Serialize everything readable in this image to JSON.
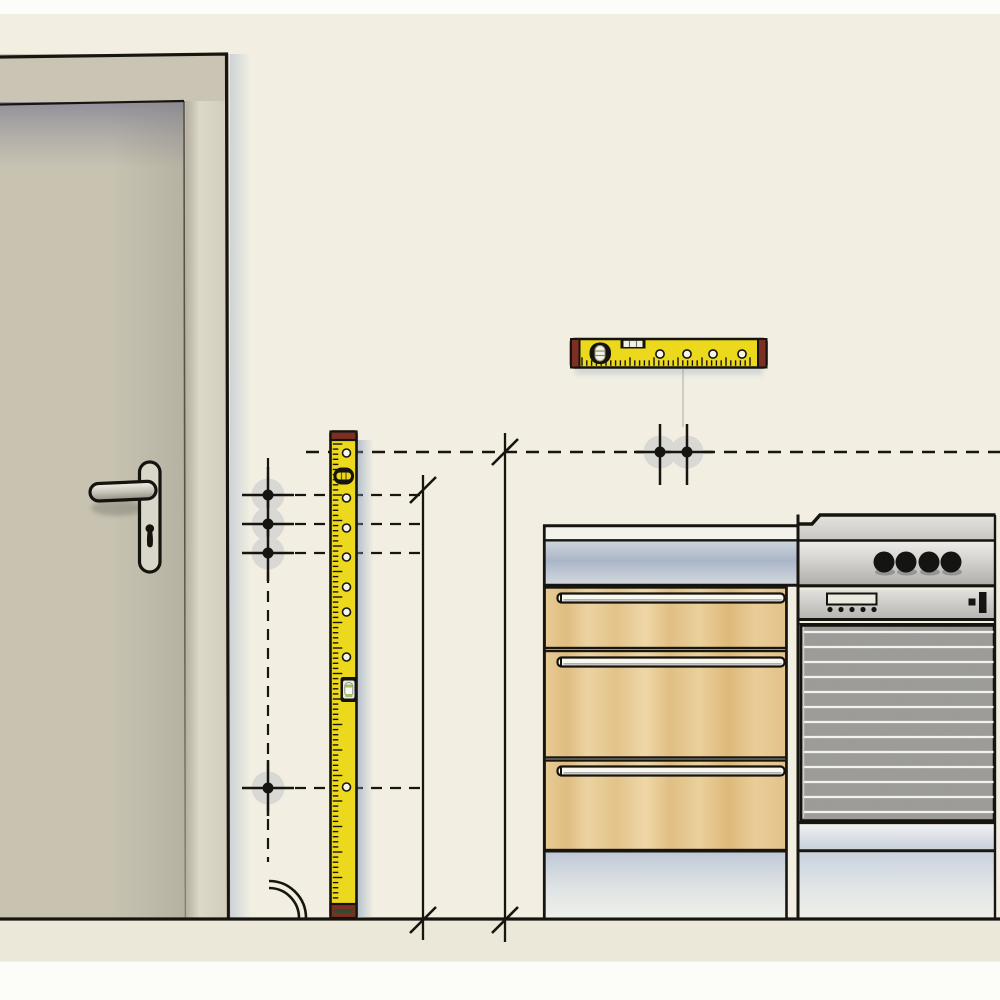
{
  "scene": {
    "page_color": "#fcfcf9",
    "outline_color": "#17150f",
    "halo_color": "#d9d8d4",
    "shadow_blue": "#9db1c9"
  },
  "wall": {
    "color": "#f2efe2"
  },
  "floor": {
    "color": "#ebe8da",
    "line_y": 919
  },
  "door": {
    "frame_color": "#c9c4b3",
    "leaf_color": "#c8c3b1",
    "jamb_color": "#d6d1c0",
    "handle_plate_color": "#d9d6ca",
    "keyhole_color": "#15130d"
  },
  "measurement": {
    "main_line": {
      "y": 452,
      "x1": 306,
      "x2": 1000
    },
    "column_line": {
      "x": 268,
      "y1": 458,
      "y2": 862
    },
    "guide_rows": [
      {
        "y": 495,
        "x1": 295,
        "x2": 420
      },
      {
        "y": 524,
        "x1": 295,
        "x2": 420
      },
      {
        "y": 553,
        "x1": 295,
        "x2": 420
      },
      {
        "y": 788,
        "x1": 295,
        "x2": 420
      }
    ],
    "drill_points": [
      {
        "x": 268,
        "y": 495
      },
      {
        "x": 268,
        "y": 524
      },
      {
        "x": 268,
        "y": 553
      },
      {
        "x": 268,
        "y": 788
      },
      {
        "x": 660,
        "y": 452
      },
      {
        "x": 687,
        "y": 452
      }
    ],
    "vertical_lines": [
      {
        "x": 423,
        "y1": 475,
        "y2": 940
      },
      {
        "x": 505,
        "y1": 433,
        "y2": 942
      }
    ],
    "slash_ticks": [
      {
        "x": 505,
        "y": 452
      },
      {
        "x": 423,
        "y": 490
      },
      {
        "x": 423,
        "y": 920
      },
      {
        "x": 505,
        "y": 920
      }
    ],
    "swing_arc": {
      "cx": 269,
      "cy": 918,
      "radii": [
        30,
        37
      ]
    },
    "pencil_line": {
      "x": 683,
      "y1": 369,
      "y2": 427
    }
  },
  "spirit_level_vertical": {
    "body_color": "#ecd91d",
    "cap_color": "#7e2f23",
    "cap_stripe_color": "#37492c",
    "hole_x": 346.5,
    "hole_ys": [
      453,
      498,
      528,
      557,
      587,
      612,
      657,
      787
    ],
    "ticks": {
      "from": 444,
      "to": 900,
      "step": 5.1,
      "long_every": 5
    }
  },
  "spirit_level_horizontal": {
    "body_color": "#ecd91d",
    "cap_color": "#7e2f23",
    "hole_y": 354,
    "hole_xs": [
      660,
      687,
      713,
      742
    ],
    "ticks": {
      "from": 582,
      "to": 754,
      "step": 4.8,
      "long_every": 5
    }
  },
  "cabinet": {
    "top_strip_color": "#f3f2ec",
    "handle_color": "#f8f7f2",
    "handle_x": 557.5,
    "handle_width": 227,
    "handles": [
      {
        "y": 593.5
      },
      {
        "y": 657.5
      },
      {
        "y": 766.5
      }
    ],
    "drawers": [
      {
        "top": 587.5,
        "bottom": 648
      },
      {
        "top": 651,
        "bottom": 757.5
      },
      {
        "top": 760.5,
        "bottom": 850
      }
    ]
  },
  "oven": {
    "door_color": "#a09f9c",
    "rib_color": "#f2f2ee",
    "knob_color": "#141412",
    "knob_y": 562,
    "knob_radius": 10.5,
    "knobs": [
      {
        "x": 884
      },
      {
        "x": 906
      },
      {
        "x": 929
      },
      {
        "x": 951
      }
    ],
    "display_dots": [
      830,
      841,
      852,
      863,
      874
    ],
    "dot_y": 609.5,
    "ribs": {
      "from": 632,
      "to": 812,
      "step": 15
    }
  }
}
